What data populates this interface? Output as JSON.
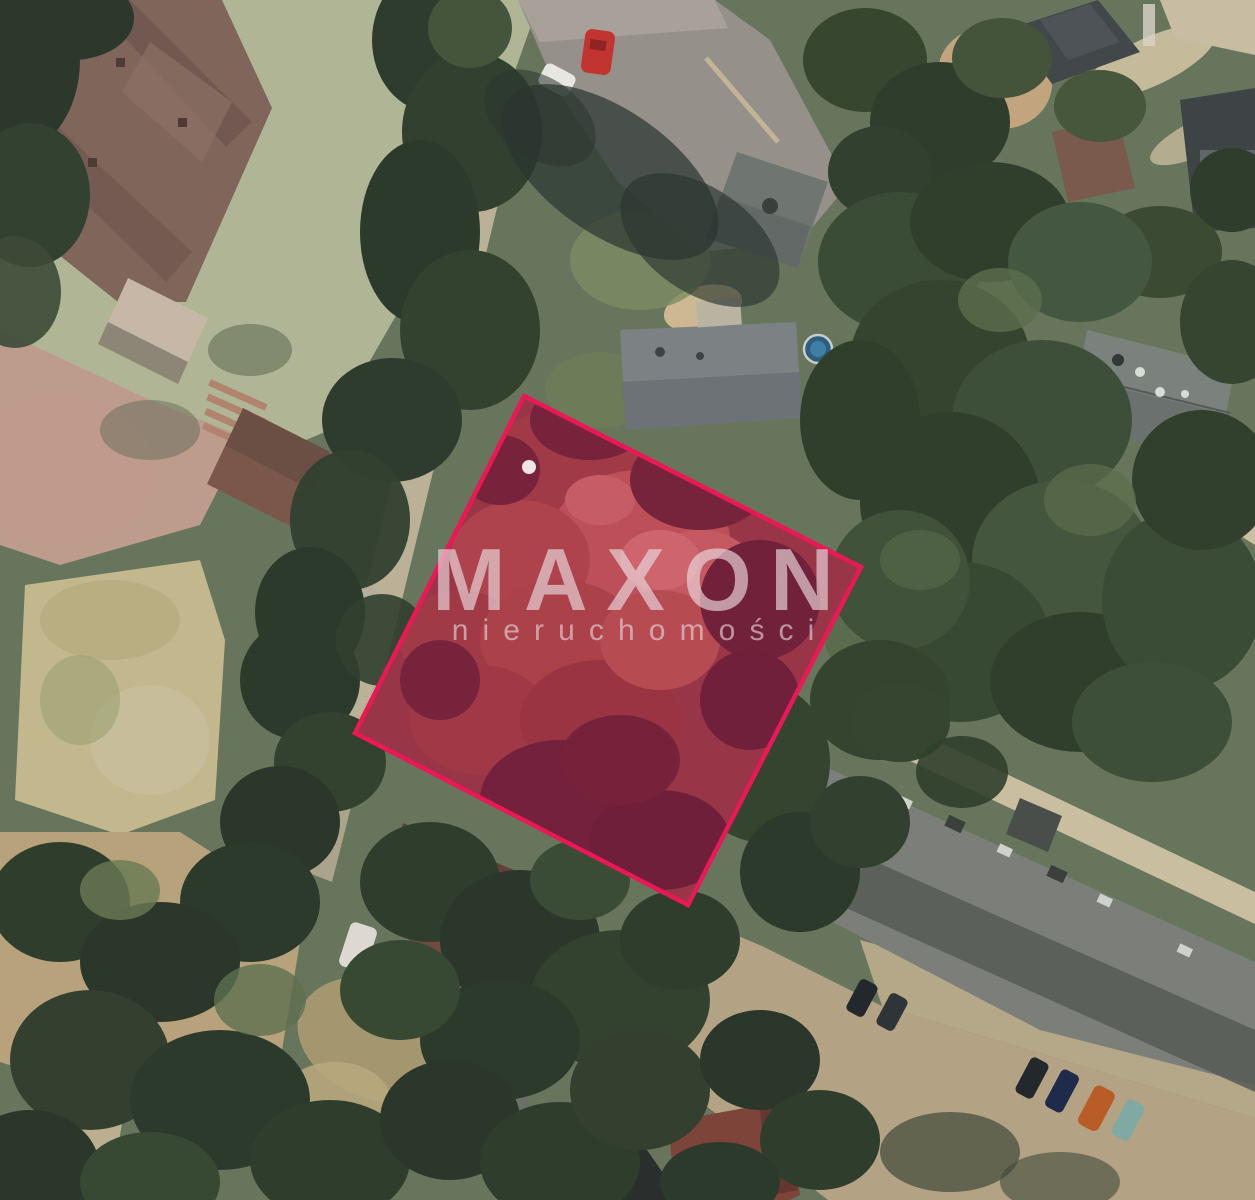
{
  "watermark": {
    "brand": "MAXON",
    "tagline": "nieruchomości",
    "color": "rgba(233,217,222,0.66)"
  },
  "map": {
    "type": "aerial-photo-of-land-parcel",
    "parcel": {
      "points": "524,396 861,567 688,905 355,733",
      "outline_color": "#ea1854",
      "fill_color": "rgba(193,14,77,0.42)"
    }
  }
}
